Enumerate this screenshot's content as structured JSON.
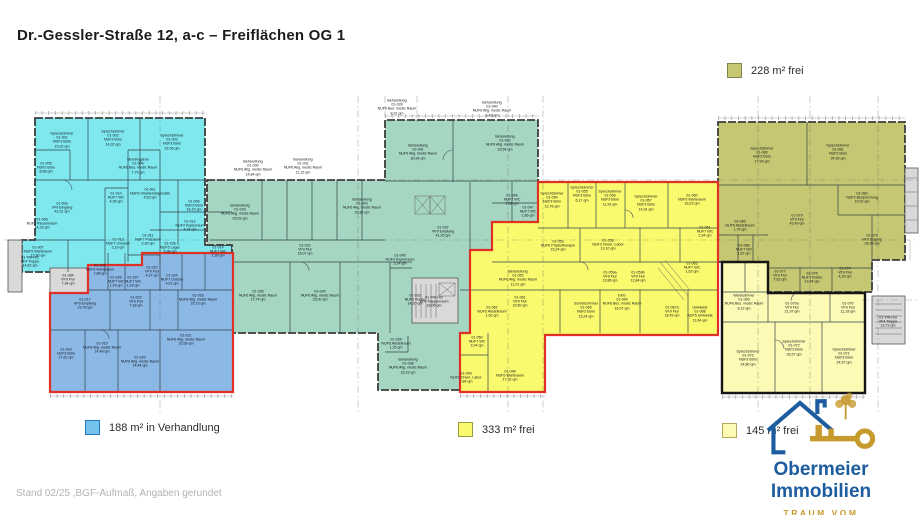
{
  "title": "Dr.-Gessler-Straße 12, a-c – Freiflächen OG 1",
  "footer_note": "Stand 02/25 ,BGF-Aufmaß, Angaben gerundet",
  "legend": {
    "olive_label": "228 m² frei",
    "blue_label": "188 m² in Verhandlung",
    "yellow_label": "333 m² frei",
    "pale_label": "145 m² frei"
  },
  "logo": {
    "name": "Obermeier Immobilien",
    "tagline": "TRAUM VOM RAUM"
  },
  "colors": {
    "cyan": "#7fe8ef",
    "teal": "#a5d6c2",
    "blue": "#8cb8e6",
    "yellow": "#fafa6e",
    "olive": "#c6c772",
    "pale": "#fcfab4",
    "gray": "#d9d9d9",
    "red": "#e03127",
    "outline": "#161616",
    "legendblue": "#74c3ee",
    "logoblue": "#1d5c9e",
    "logogold": "#c79a2e"
  },
  "plan": {
    "rooms": [
      {
        "x": 62,
        "y": 140,
        "label": "Sprechzimmer\n01-001\nNUF3 Büro\n15,02 qm"
      },
      {
        "x": 113,
        "y": 138,
        "label": "Sprechzimmer\n01-002\nNUF3 Büro\n14,32 qm"
      },
      {
        "x": 172,
        "y": 142,
        "label": "Sprechzimmer\n01-003\nNUF3 Büro\n22,06 qm"
      },
      {
        "x": 138,
        "y": 166,
        "label": "Mundhygiene\n01-004\nNUF6 Bes. medic Raum\n7,79 qm"
      },
      {
        "x": 46,
        "y": 168,
        "label": "01-005\nNUF2 Büro\n8,68 qm"
      },
      {
        "x": 62,
        "y": 208,
        "label": "01-00a\nVF9 Eingang\n42,51 qm"
      },
      {
        "x": 42,
        "y": 224,
        "label": "01-006\nNUF3 Pausenraum\n14,33 qm"
      },
      {
        "x": 38,
        "y": 252,
        "label": "01-007\nNUF5 Warteraum\n13,96 qm"
      },
      {
        "x": 194,
        "y": 206,
        "label": "01-00b\nNUF3 Büro\n18,15 qm"
      },
      {
        "x": 190,
        "y": 226,
        "label": "01-012\nNUF3 Kopierraum\n4,24 qm"
      },
      {
        "x": 116,
        "y": 198,
        "label": "01-010\nNUF7 WC\n4,35 qm"
      },
      {
        "x": 150,
        "y": 194,
        "label": "01-00c\nNUF6 Strahlendiagnostik\n4,52 qm"
      },
      {
        "x": 148,
        "y": 240,
        "label": "01-011\nNUF7 Putzraum\n2,30 qm"
      },
      {
        "x": 118,
        "y": 244,
        "label": "01-013\nNUF7 Vorraum\n3,19 qm"
      },
      {
        "x": 218,
        "y": 252,
        "label": "01-014\nNUF7 WC\n1,93 qm"
      },
      {
        "x": 170,
        "y": 248,
        "label": "01-028\nNUF5 Lager\n5,98 qm"
      },
      {
        "x": 100,
        "y": 270,
        "label": "01-025\nNUF5 Warteraum\n7,88 qm"
      },
      {
        "x": 85,
        "y": 304,
        "label": "01-017\nVF9 Empfang\n23,76 qm"
      },
      {
        "x": 136,
        "y": 302,
        "label": "01-022\nVF9 Flur\n7,18 qm"
      },
      {
        "x": 198,
        "y": 300,
        "label": "01-016\nNUF6 Allg. medic Raum\n18,73 qm"
      },
      {
        "x": 66,
        "y": 354,
        "label": "01-018\nNUF3 Büro\n17,62 qm"
      },
      {
        "x": 102,
        "y": 348,
        "label": "01-019\nNUF6 Allg. medic Raum\n14,48 qm"
      },
      {
        "x": 140,
        "y": 362,
        "label": "01-020\nNUF6 Allg. medic Raum\n14,44 qm"
      },
      {
        "x": 186,
        "y": 340,
        "label": "01-021\nNUF6 Allg. medic Raum\n16,56 qm"
      },
      {
        "x": 116,
        "y": 282,
        "label": "01-026\nNUF7 WC\n1,29 qm"
      },
      {
        "x": 133,
        "y": 282,
        "label": "01-027\nNUF7 WC\n1,29 qm"
      },
      {
        "x": 172,
        "y": 280,
        "label": "01-024\nNUF7 Dusche\n4,01 qm"
      },
      {
        "x": 152,
        "y": 272,
        "label": "01-023\nVF9 Flur\n4,37 qm"
      },
      {
        "x": 253,
        "y": 168,
        "label": "Behandlung\n01-030\nNUF6 Allg. medic Raum\n14,84 qm"
      },
      {
        "x": 303,
        "y": 166,
        "label": "Behandlung\n01-031\nNUF6 Allg. medic Raum\n11,15 qm"
      },
      {
        "x": 397,
        "y": 107,
        "label": "Behandlung\n01-039\nNUF6 Bes. medic Raum\n8,31 qm"
      },
      {
        "x": 492,
        "y": 109,
        "label": "Behandlung\n01-040\nNUF6 Allg. medic Raum\n9,43 qm"
      },
      {
        "x": 418,
        "y": 152,
        "label": "Behandlung\n01-041\nNUF6 Allg. medic Raum\n30,94 qm"
      },
      {
        "x": 505,
        "y": 143,
        "label": "Behandlung\n01-042\nNUF6 Allg. medic Raum\n29,54 qm"
      },
      {
        "x": 362,
        "y": 206,
        "label": "Behandlung\n01-043\nNUF6 Allg. medic Raum\n29,85 qm"
      },
      {
        "x": 240,
        "y": 212,
        "label": "Behandlung\n01-029\nNUF6 Allg. medic Raum\n29,02 qm"
      },
      {
        "x": 305,
        "y": 250,
        "label": "01-032\nVF9 Flur\n16,07 qm"
      },
      {
        "x": 443,
        "y": 232,
        "label": "01-037\nVF9 Empfang\n41,25 qm"
      },
      {
        "x": 258,
        "y": 296,
        "label": "01-035\nNUF6 Allg. medic Raum\n17,74 qm"
      },
      {
        "x": 320,
        "y": 296,
        "label": "01-034\nNUF6 Allg. medic Raum\n23,00 qm"
      },
      {
        "x": 415,
        "y": 300,
        "label": "01-033\nNUF3 Küche\n14,20 qm"
      },
      {
        "x": 408,
        "y": 366,
        "label": "Behandlung\n01-038\nNUF6 Allg. medic Raum\n18,23 qm"
      },
      {
        "x": 396,
        "y": 344,
        "label": "01-036\nNUF5 Abstellraum\n1,25 qm"
      },
      {
        "x": 400,
        "y": 260,
        "label": "01-045\nNUF3 Kopierraum\n3,24 qm"
      },
      {
        "x": 512,
        "y": 200,
        "label": "01-046\nNUF7 WC\n2,08 qm"
      },
      {
        "x": 528,
        "y": 212,
        "label": "01-047\nNUF7 WC\n1,86 qm"
      },
      {
        "x": 552,
        "y": 200,
        "label": "Sprechzimmer\n01-054\nNUF3 Büro\n12,76 qm"
      },
      {
        "x": 582,
        "y": 194,
        "label": "Sprechzimmer\n01-055\nNUF3 Büro\n6,17 qm"
      },
      {
        "x": 610,
        "y": 198,
        "label": "Sprechzimmer\n01-056\nNUF3 Büro\n11,93 qm"
      },
      {
        "x": 646,
        "y": 203,
        "label": "Sprechzimmer\n01-057\nNUF3 Büro\n14,91 qm"
      },
      {
        "x": 692,
        "y": 200,
        "label": "01-060\nNUF5 Warteraum\n18,23 qm"
      },
      {
        "x": 558,
        "y": 246,
        "label": "01-053\nNUF6 Physiotherapie\n15,24 qm"
      },
      {
        "x": 608,
        "y": 245,
        "label": "01-058\nNUF3 Chem.-Labor\n13,10 qm"
      },
      {
        "x": 518,
        "y": 278,
        "label": "Behandlung\n01-052\nNUF6 Allg. medic Raum\n11,01 qm"
      },
      {
        "x": 610,
        "y": 277,
        "label": "01-059a\nVF9 Flur\n13,86 qm"
      },
      {
        "x": 638,
        "y": 277,
        "label": "01-059b\nVF9 Flur\n12,84 qm"
      },
      {
        "x": 520,
        "y": 302,
        "label": "01-061\nVF9 Flur\n19,50 qm"
      },
      {
        "x": 492,
        "y": 312,
        "label": "01-062\nNUF5 Abstellraum\n1,53 qm"
      },
      {
        "x": 586,
        "y": 310,
        "label": "Schreibzimmer\n01-065\nNUF2 Büro\n15,24 qm"
      },
      {
        "x": 622,
        "y": 302,
        "label": "EKG\n01-064\nNUF6 Bes. medic Raum\n16,97 qm"
      },
      {
        "x": 672,
        "y": 312,
        "label": "01-067a\nVF9 Flur\n18,49 qm"
      },
      {
        "x": 700,
        "y": 314,
        "label": "Umkleide\n01-068\nNUF5 Umkleide\n11,64 qm"
      },
      {
        "x": 466,
        "y": 378,
        "label": "01-049\nNUF3 Chem. Labor\n7,84 qm"
      },
      {
        "x": 510,
        "y": 376,
        "label": "01-048\nNUF5 Warteraum\n17,32 qm"
      },
      {
        "x": 477,
        "y": 342,
        "label": "01-050\nNUF7 WC\n2,04 qm"
      },
      {
        "x": 692,
        "y": 268,
        "label": "01-063\nNUF7 WC\n1,63 qm"
      },
      {
        "x": 705,
        "y": 232,
        "label": "01-051\nNUF7 WC\n2,94 qm"
      },
      {
        "x": 762,
        "y": 155,
        "label": "Sprechzimmer\n01-080\nNUF2 Büro\n17,93 qm"
      },
      {
        "x": 838,
        "y": 152,
        "label": "Sprechzimmer\n01-081\nNUF2 Büro\n34,95 qm"
      },
      {
        "x": 862,
        "y": 198,
        "label": "01-083\nNUF2 Besprechung\n19,02 qm"
      },
      {
        "x": 797,
        "y": 220,
        "label": "01-079\nVF9 Flur\n43,49 qm"
      },
      {
        "x": 872,
        "y": 240,
        "label": "01-078\nVF9 Zugang\n28,99 qm"
      },
      {
        "x": 740,
        "y": 226,
        "label": "01-085\nNUF5 Abstellraum\n1,76 qm"
      },
      {
        "x": 744,
        "y": 250,
        "label": "01-086\nNUF7 WC\n1,57 qm"
      },
      {
        "x": 812,
        "y": 278,
        "label": "01-075\nNUF3 Küche\n13,64 qm"
      },
      {
        "x": 780,
        "y": 276,
        "label": "01-077\nVF9 Flur\n7,62 qm"
      },
      {
        "x": 845,
        "y": 273,
        "label": "01-074\nVF9 Flur\n4,29 qm"
      },
      {
        "x": 744,
        "y": 302,
        "label": "Wartezimmer\n01-069\nNUF6 Bes. medic Raum\n8,12 qm"
      },
      {
        "x": 792,
        "y": 308,
        "label": "01-070a\nVF9 Flur\n21,97 qm"
      },
      {
        "x": 848,
        "y": 308,
        "label": "01-070\nVF9 Flur\n11,18 qm"
      },
      {
        "x": 748,
        "y": 358,
        "label": "Sprechzimmer\n01-073\nNUF3 Büro\n24,80 qm"
      },
      {
        "x": 794,
        "y": 348,
        "label": "Sprechzimmer\n01-072\nNUF3 Büro\n26,57 qm"
      },
      {
        "x": 844,
        "y": 356,
        "label": "Sprechzimmer\n01-071\nNUF3 Büro\n24,57 qm"
      },
      {
        "x": 434,
        "y": 302,
        "label": "01-TRH-02\nVF4 Treppenraum\n18,06 qm"
      },
      {
        "x": 68,
        "y": 280,
        "label": "01-084\nVF9 Flur\n7,34 qm"
      },
      {
        "x": 30,
        "y": 262,
        "label": "01-TRH-01\nVF4 Treppe\n14,62 qm"
      },
      {
        "x": 888,
        "y": 322,
        "label": "01-TRH-03\nVF4 Treppe\n13,73 qm"
      }
    ]
  }
}
